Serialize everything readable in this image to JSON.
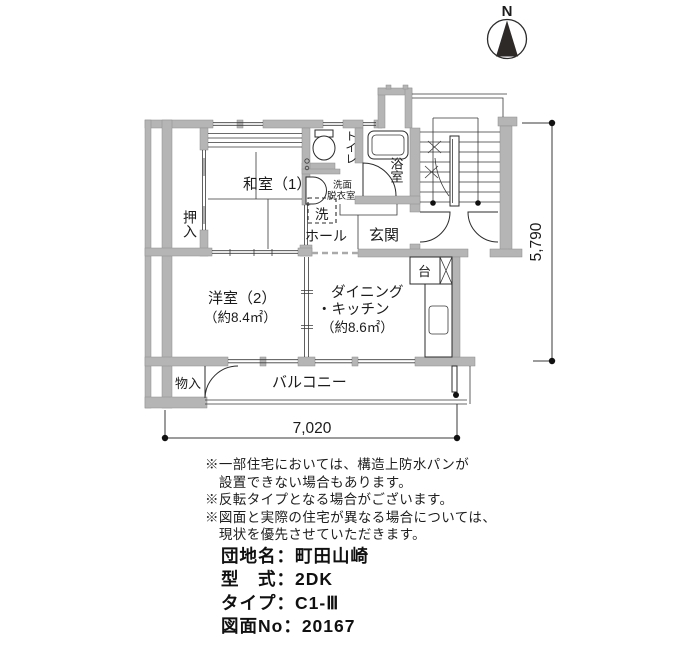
{
  "compass": {
    "north_label": "N"
  },
  "plan": {
    "rooms": {
      "oshiire": "押入",
      "washitsu": "和室（1）",
      "toilet": "トイレ",
      "senmen_line1": "洗面",
      "senmen_line2": "脱衣室",
      "laundry_pan": "洗",
      "hall": "ホール",
      "genkan": "玄関",
      "bathroom": "浴室",
      "counter": "台",
      "yoshitsu": "洋室（2）",
      "yoshitsu_area": "（約8.4㎡）",
      "dk_line1": "ダイニング",
      "dk_line2": "・キッチン",
      "dk_area": "（約8.6㎡）",
      "monoire": "物入",
      "balcony": "バルコニー"
    },
    "dimensions": {
      "width_mm": "7,020",
      "depth_mm": "5,790"
    }
  },
  "notes": {
    "lines": [
      "※一部住宅においては、構造上防水パンが",
      "　設置できない場合もあります。",
      "※反転タイプとなる場合がございます。",
      "※図面と実際の住宅が異なる場合については、",
      "　現状を優先させていただきます。"
    ]
  },
  "info": {
    "lines": [
      "団地名：町田山崎",
      "型　式：2DK",
      "タイプ：C1-Ⅲ",
      "図面No：20167"
    ]
  },
  "colors": {
    "wall": "#b5b5b5",
    "line": "#2b2b2b",
    "compass_fill": "#2e2a28"
  }
}
